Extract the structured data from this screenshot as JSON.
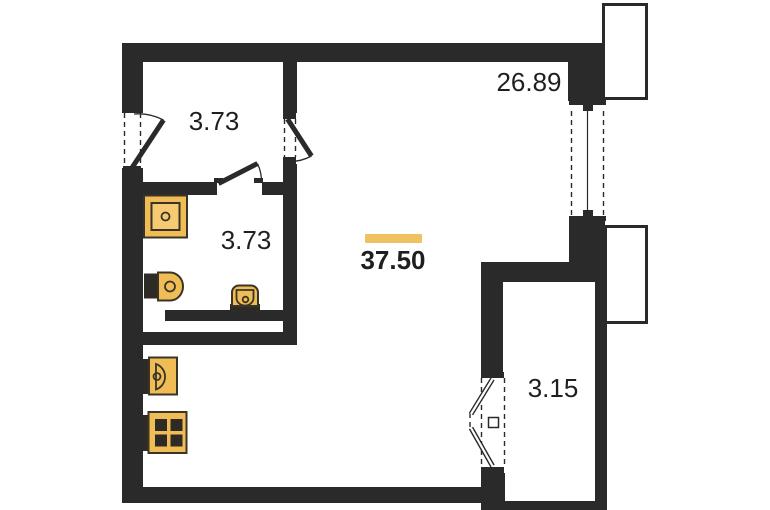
{
  "colors": {
    "bg": "#ffffff",
    "wall": "#2a2a2a",
    "text": "#1f1f1f",
    "accent": "#efc161",
    "fixture": "#f0bc55",
    "fixture-light": "#f6ca73",
    "fixture-dark": "#2e2b26",
    "fixture-stroke": "#3a3428"
  },
  "rooms": {
    "hallway": {
      "area": "3.73"
    },
    "bathroom": {
      "area": "3.73"
    },
    "living": {
      "area": "26.89"
    },
    "total": {
      "area": "37.50"
    },
    "loggia": {
      "area": "3.15"
    }
  },
  "icons": [
    "shower-tray-icon",
    "toilet-icon",
    "washbasin-icon",
    "kitchen-sink-icon",
    "stove-icon",
    "door-leaf-icon",
    "window-icon",
    "balcony-icon"
  ]
}
